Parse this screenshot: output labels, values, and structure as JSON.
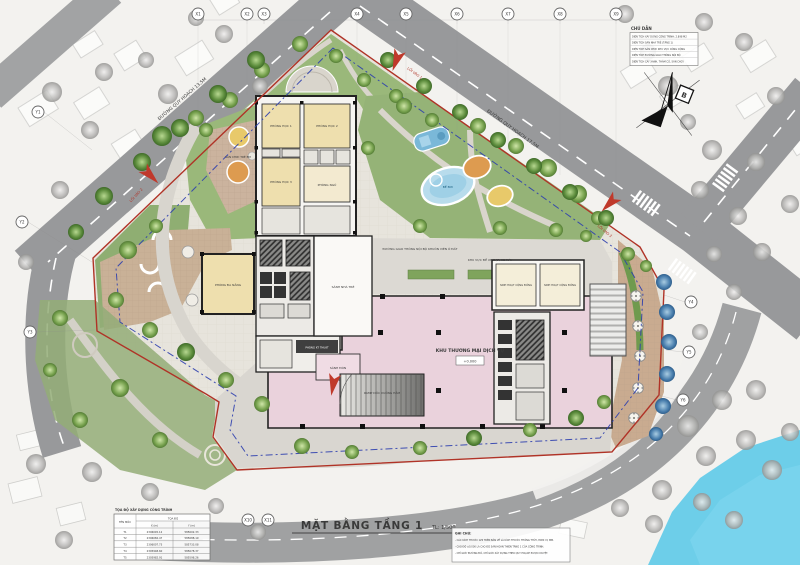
{
  "drawing": {
    "title": "MẶT BẰNG TẦNG 1",
    "scale": "TL: 1/500"
  },
  "legend": {
    "title": "CHÚ DẪN",
    "items": [
      "DIỆN TÍCH XÂY DỰNG CÔNG TRÌNH: 2.898 M2",
      "DIỆN TÍCH SÂN NHÀ TRẺ (TẦNG 1)",
      "DIỆN TÍCH SÂN CHƠI KHU VỰC CÔNG CỘNG",
      "DIỆN TÍCH ĐƯỜNG GIAO THÔNG NỘI BỘ",
      "DIỆN TÍCH CÂY XANH, THẢM CỎ, SÂN CHƠI"
    ]
  },
  "north_label": "B",
  "coord_table": {
    "title": "TỌA ĐỘ XÂY DỰNG CÔNG TRÌNH",
    "col_point": "TÊN MỐC",
    "col_group": "TỌA ĐỘ",
    "col_x": "X (m)",
    "col_y": "Y (m)",
    "rows": [
      {
        "name": "T1",
        "x": "2306045.12",
        "y": "585602.33"
      },
      {
        "name": "T2",
        "x": "2306082.47",
        "y": "585688.19"
      },
      {
        "name": "T3",
        "x": "2306007.73",
        "y": "585733.08"
      },
      {
        "name": "T4",
        "x": "2305948.60",
        "y": "585678.37"
      },
      {
        "name": "T5",
        "x": "2305982.91",
        "y": "585598.26"
      }
    ]
  },
  "notes": {
    "title": "GHI CHÚ:",
    "lines": [
      "- CÁC KÍCH THƯỚC GHI TRÊN BẢN VẼ LÀ KÍCH THƯỚC THÔNG THỦY, ĐƠN VỊ: MM.",
      "- CAO ĐỘ ±0.000 LÀ CAO ĐỘ SÀN HOÀN THIỆN TẦNG 1 CỦA CÔNG TRÌNH.",
      "- CHỈ GIỚI ĐƯỜNG ĐỎ, CHỈ GIỚI XÂY DỰNG THEO QUY HOẠCH ĐƯỢC DUYỆT."
    ]
  },
  "rooms": {
    "classroom1": "PHÒNG HỌC 1",
    "classroom2": "PHÒNG HỌC 2",
    "classroom3": "PHÒNG HỌC 3",
    "bedroom": "PHÒNG NGỦ",
    "multipurpose": "PHÒNG ĐA NĂNG",
    "nursery_lobby": "SẢNH NHÀ TRẺ",
    "reception": "SẢNH ĐÓN",
    "community": "SINH HOẠT CỘNG ĐỒNG",
    "technical": "PHÒNG KỸ THUẬT",
    "commercial": "KHU THƯƠNG MẠI DỊCH VỤ",
    "level": "+0.000",
    "ramp": "RAMP DỐC XUỐNG HẦM",
    "pool": "BỂ BƠI"
  },
  "site_labels": {
    "playground": "SÂN CHƠI TRẺ EM",
    "internal_road": "ĐƯỜNG GIAO THÔNG NỘI BỘ KHUÔN VIÊN Ô ĐẤT",
    "bike": "KHU VỰC ĐỂ XE ĐẠP, XE MÁY",
    "road_ne": "ĐƯỜNG QUY HOẠCH 17,5M",
    "road_nw": "ĐƯỜNG QUY HOẠCH 13,5M",
    "entrance1": "LỐI VÀO 1",
    "entrance2": "LỐI VÀO 2",
    "entrance3": "LỐI VÀO 3"
  },
  "grid": {
    "top": [
      "X1",
      "X2",
      "X3",
      "X4",
      "X5",
      "X6",
      "X7",
      "X8",
      "X9"
    ],
    "left": [
      "Y1",
      "Y2",
      "Y3"
    ],
    "right": [
      "Y4",
      "Y5",
      "Y6"
    ],
    "bottom": [
      "X10",
      "X11"
    ]
  },
  "colors": {
    "boundary_red": "#b03327",
    "setback_blue": "#2e3fae",
    "commercial_pink": "#ead2dc",
    "room_yellow": "#eedfae",
    "lawn_green": "#8fae72",
    "water_blue": "#62cbe8",
    "road_gray": "#98999b"
  }
}
